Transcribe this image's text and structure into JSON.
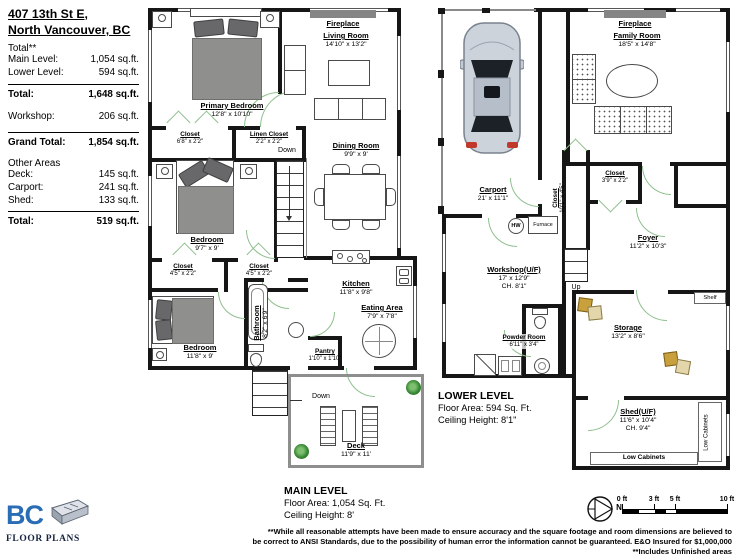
{
  "colors": {
    "wall": "#161616",
    "door_green": "#8fbf8f",
    "logo_blue": "#2a6db5",
    "plant_green": "#2e7b2e",
    "box_gold": "#c8a03c"
  },
  "sidebar": {
    "title_line1": "407 13th St E,",
    "title_line2": "North Vancouver, BC",
    "total_header": "Total**",
    "rows": [
      {
        "label": "Main Level:",
        "value": "1,054 sq.ft."
      },
      {
        "label": "Lower Level:",
        "value": "594 sq.ft."
      }
    ],
    "total": {
      "label": "Total:",
      "value": "1,648 sq.ft."
    },
    "workshop": {
      "label": "Workshop:",
      "value": "206 sq.ft."
    },
    "grand_total": {
      "label": "Grand Total:",
      "value": "1,854 sq.ft."
    },
    "other_header": "Other Areas",
    "other_rows": [
      {
        "label": "Deck:",
        "value": "145 sq.ft."
      },
      {
        "label": "Carport:",
        "value": "241 sq.ft."
      },
      {
        "label": "Shed:",
        "value": "133 sq.ft."
      }
    ],
    "other_total": {
      "label": "Total:",
      "value": "519 sq.ft."
    },
    "logo": {
      "bc": "BC",
      "text": "FLOOR PLANS"
    }
  },
  "main_level": {
    "fireplace": "Fireplace",
    "primary_bedroom": {
      "name": "Primary Bedroom",
      "dims": "12'8\" x 10'10\""
    },
    "living_room": {
      "name": "Living Room",
      "dims": "14'10\" x 13'2\""
    },
    "closet1": {
      "name": "Closet",
      "dims": "6'8\" x 2'2\""
    },
    "linen_closet": {
      "name": "Linen Closet",
      "dims": "2'2\" x 2'2\""
    },
    "dining_room": {
      "name": "Dining Room",
      "dims": "9'9\" x 9'"
    },
    "bedroom2": {
      "name": "Bedroom",
      "dims": "9'7\" x 9'"
    },
    "closet2": {
      "name": "Closet",
      "dims": "4'5\" x 2'2\""
    },
    "closet3": {
      "name": "Closet",
      "dims": "4'5\" x 2'2\""
    },
    "kitchen": {
      "name": "Kitchen",
      "dims": "11'8\" x 9'8\""
    },
    "eating_area": {
      "name": "Eating Area",
      "dims": "7'9\" x 7'8\""
    },
    "bedroom3": {
      "name": "Bedroom",
      "dims": "11'8\" x 9'"
    },
    "bathroom": {
      "name": "Bathroom",
      "dims": "8'2\" x 6'9\""
    },
    "pantry": {
      "name": "Pantry",
      "dims": "1'10\" x 1'10\""
    },
    "deck": {
      "name": "Deck",
      "dims": "11'9\" x 11'"
    },
    "down_stairs": "Down",
    "down_deck": "Down",
    "footer": {
      "title": "MAIN LEVEL",
      "area": "Floor Area: 1,054 Sq. Ft.",
      "ceiling": "Ceiling Height: 8'"
    }
  },
  "lower_level": {
    "fireplace": "Fireplace",
    "carport": {
      "name": "Carport",
      "dims": "21' x 11'1\""
    },
    "family_room": {
      "name": "Family Room",
      "dims": "18'5\" x 14'8\""
    },
    "closet_tall": {
      "name": "Closet",
      "dims": "10'1\" x 4'5\""
    },
    "closet_small": {
      "name": "Closet",
      "dims": "3'9\" x 2'2\""
    },
    "foyer": {
      "name": "Foyer",
      "dims": "11'2\" x 10'3\""
    },
    "workshop": {
      "name": "Workshop(U/F)",
      "dims": "17' x 12'9\"",
      "ch": "CH. 8'1\""
    },
    "hw": "HW",
    "furnace": "Furnace",
    "up": "Up",
    "powder_room": {
      "name": "Powder Room",
      "dims": "6'11\" x 3'4\""
    },
    "storage": {
      "name": "Storage",
      "dims": "13'2\" x 8'6\""
    },
    "shelf": "Shelf",
    "shed": {
      "name": "Shed(U/F)",
      "dims": "11'6\" x 10'4\"",
      "ch": "CH. 9'4\""
    },
    "low_cabinets_right": "Low Cabinets",
    "low_cabinets_bottom": "Low Cabinets",
    "footer": {
      "title": "LOWER LEVEL",
      "area": "Floor Area: 594 Sq. Ft.",
      "ceiling": "Ceiling Height: 8'1\""
    }
  },
  "footer": {
    "compass_n": "N",
    "scale": {
      "t0": "0 ft",
      "t3": "3 ft",
      "t5": "5 ft",
      "t10": "10 ft"
    },
    "disclaimer1": "**While all reasonable attempts have been made to ensure accuracy and the square footage and room dimensions are believed to",
    "disclaimer2": "be correct to ANSI Standards, due to the possibility of human error the information cannot be guaranteed. E&O Insured for $1,000,000",
    "disclaimer3": "**Includes Unfinished areas"
  }
}
